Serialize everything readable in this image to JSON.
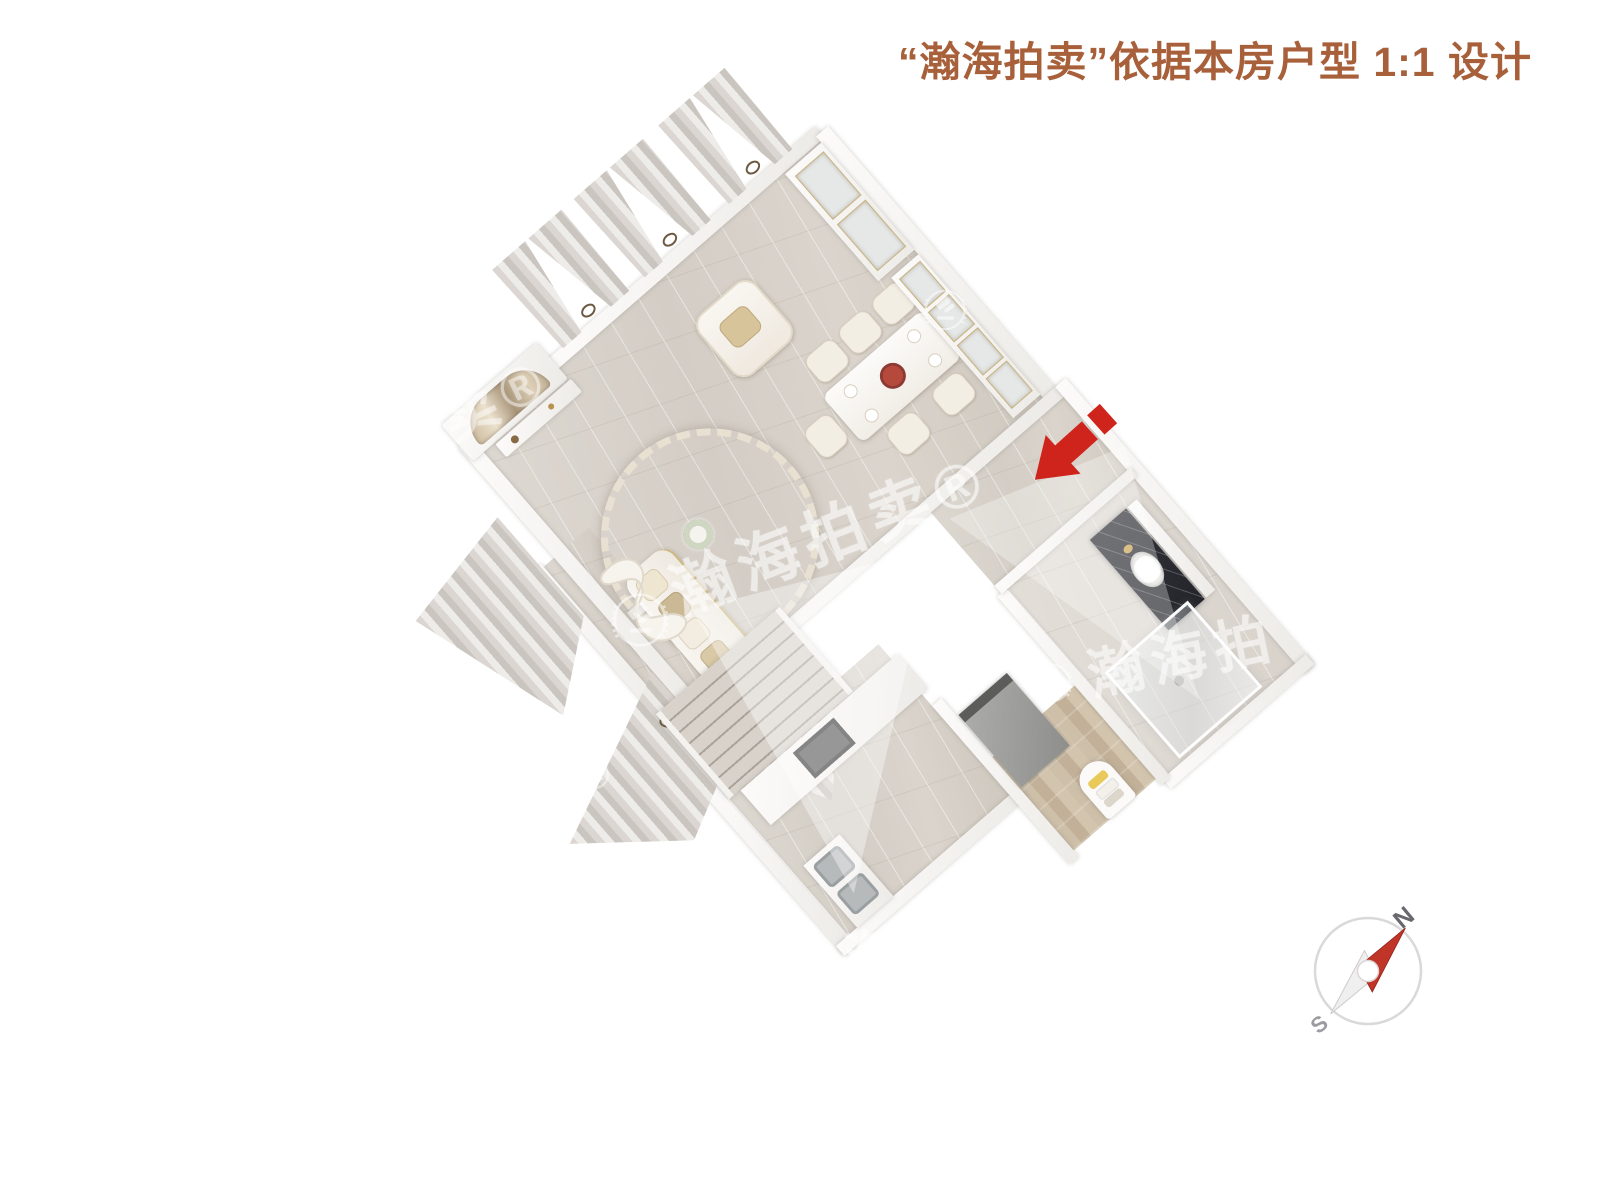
{
  "title": {
    "text": "“瀚海拍卖”依据本房户型 1:1 设计",
    "color": "#A8603B"
  },
  "compass": {
    "north_label": "N",
    "south_label": "S",
    "needle_color": "#C13529",
    "ring_color": "#D9D9D9"
  },
  "entrance_arrow": {
    "color": "#CF241B",
    "direction": "down-left",
    "meaning": "unit-entrance-indicator"
  },
  "watermark": {
    "brand": "瀚海拍卖",
    "registered_mark": "®",
    "logo": "hanhai-laurel-gavel-emblem",
    "instances": [
      {
        "text": "瀚海拍卖®",
        "location": "living-room"
      },
      {
        "text": "瀚海拍",
        "location": "bathroom"
      },
      {
        "text": "海拍卖®",
        "location": "kitchen-south"
      },
      {
        "text": "拍卖®",
        "location": "tv-wall"
      },
      {
        "text": "卖®",
        "location": "stairs"
      }
    ]
  },
  "floor_plan": {
    "type": "3d-top-down-apartment-render",
    "rotation_deg": -41,
    "rooms": [
      {
        "name": "living-room",
        "furniture": [
          "round-ornate-rug",
          "dark-round-coffee-table",
          "sofa",
          "armchair",
          "chaise-longue",
          "tv-marble-feature-wall",
          "tv-console"
        ]
      },
      {
        "name": "dining-room",
        "furniture": [
          "dining-table",
          "six-chairs",
          "floral-centerpiece",
          "tall-display-cabinet",
          "sideboard-cabinet"
        ]
      },
      {
        "name": "kitchen",
        "furniture": [
          "l-shaped-counter",
          "double-sink",
          "cooktop",
          "refrigerator"
        ]
      },
      {
        "name": "bathroom",
        "furniture": [
          "dark-marble-vanity",
          "oval-sink",
          "glass-shower"
        ]
      },
      {
        "name": "entry-hall",
        "furniture": []
      },
      {
        "name": "corridor",
        "furniture": [
          "wood-floor",
          "towel-niche"
        ]
      },
      {
        "name": "staircase",
        "furniture": [
          "steps"
        ]
      },
      {
        "name": "windows",
        "furniture": [
          "curtain-pairs-with-tiebacks"
        ]
      }
    ],
    "colors": {
      "marble_floor": "#D8D2CA",
      "wood_floor": "#C9B9A4",
      "walls": "#F4F2EF",
      "rug_gold": "#A8905E",
      "vanity_dark": "#33343A"
    }
  }
}
